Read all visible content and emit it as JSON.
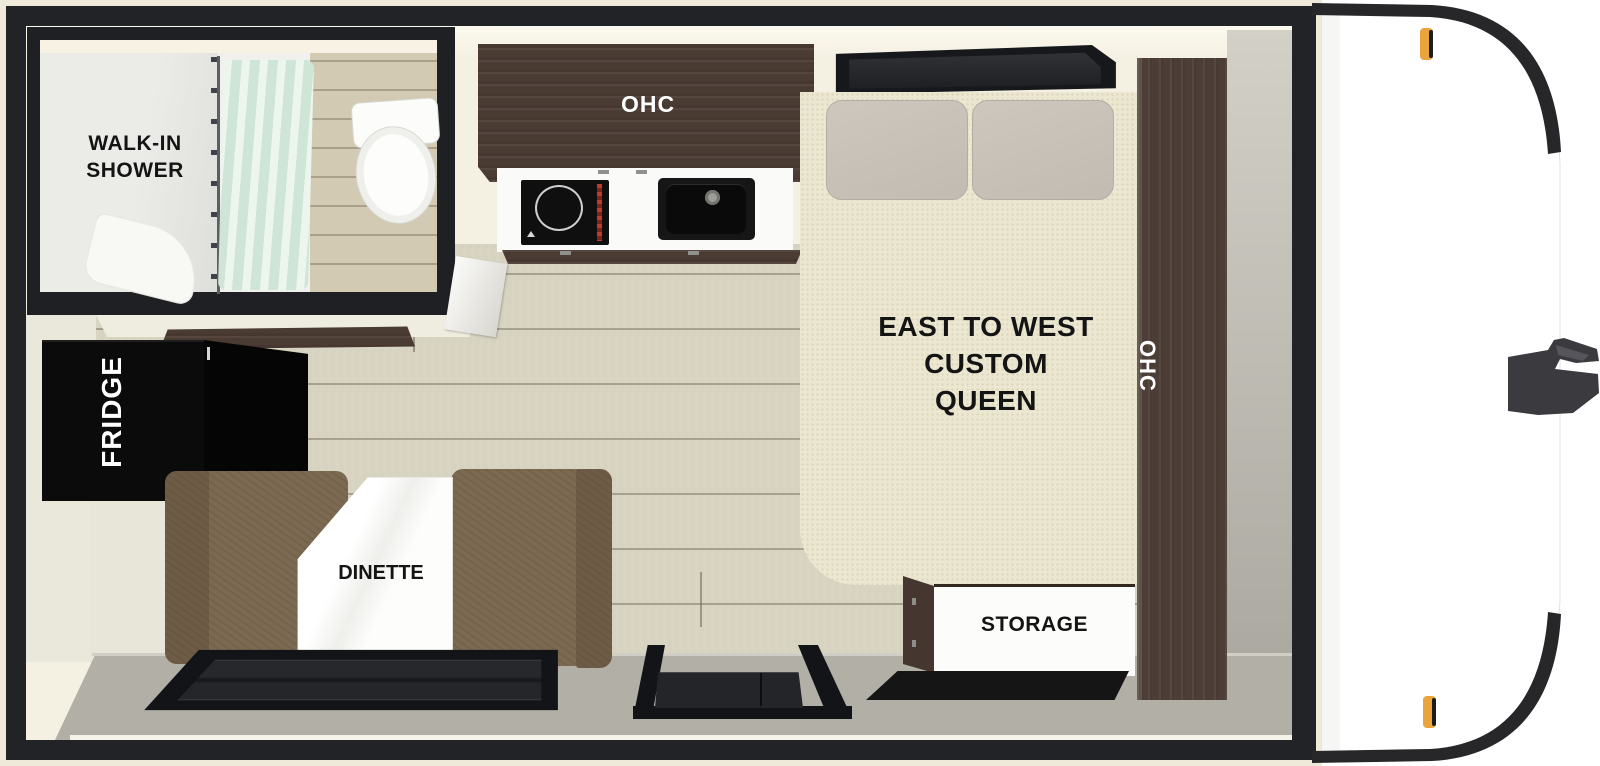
{
  "areas": {
    "bathroom": {
      "label_line1": "WALK-IN",
      "label_line2": "SHOWER"
    },
    "kitchen": {
      "ohc_label": "OHC"
    },
    "bedroom": {
      "bed_label_line1": "EAST TO WEST",
      "bed_label_line2": "CUSTOM",
      "bed_label_line3": "QUEEN",
      "side_ohc_label": "OHC"
    },
    "galley": {
      "fridge_label": "FRIDGE"
    },
    "dinette": {
      "label": "DINETTE"
    },
    "storage": {
      "label": "STORAGE"
    }
  },
  "colors": {
    "shell_cream": "#efe9da",
    "wall_black": "#222326",
    "floor_wood": "#d7d3c0",
    "entry_floor_gray": "#b1afa6",
    "cabinet_wood_brown": "#4a3b33",
    "bed_cream": "#ece7d1",
    "pillow_gray": "#c8c2b9",
    "bench_brown": "#7b6951",
    "curtain_mint": "#dcefe3",
    "marker_light_amber": "#e9a43c",
    "hitch_gray": "#3a3a3f"
  },
  "features": {
    "shower_curtain": "css-shape",
    "toilet": "css-shape",
    "bathroom_door": "css-shape",
    "cooktop": "css-shape",
    "sink": "css-shape",
    "bed_window": "css-shape",
    "rear_window": "css-shape",
    "entry_step": "css-shape",
    "floor_mat": "css-shape",
    "fridge": "css-shape",
    "front_cap": "css-shape",
    "hitch_coupler": "css-shape",
    "marker_lights": "css-shape"
  }
}
